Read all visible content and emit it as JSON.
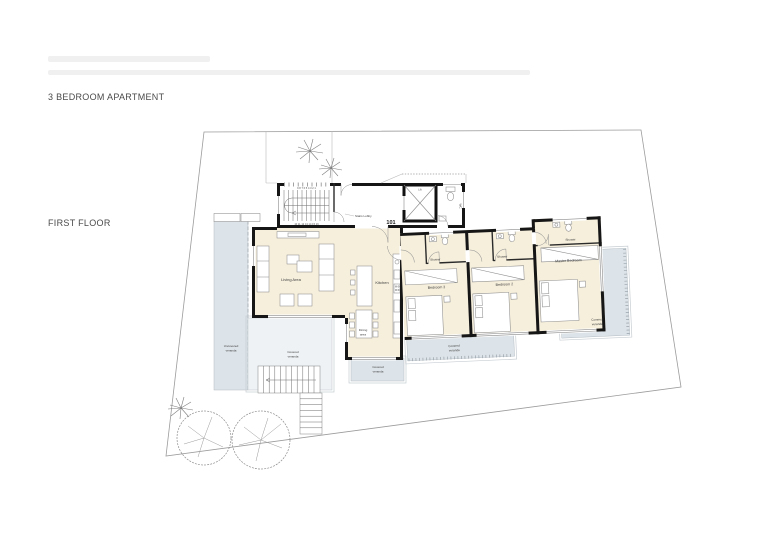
{
  "page": {
    "apartment_title": "3 BEDROOM APARTMENT",
    "floor_label": "FIRST FLOOR"
  },
  "plan": {
    "unit_number": "101",
    "labels": {
      "living": "Living Area",
      "kitchen": "Kitchen",
      "dining_line1": "Dining",
      "dining_line2": "area",
      "stairs_lobby": "Stairs Lobby",
      "lift": "Lift",
      "wc": "WC",
      "shower": "Shower",
      "bedroom3": "Bedroom 3",
      "bedroom2": "Bedroom 2",
      "master_bedroom": "Master Bedroom",
      "covered_line1": "Covered",
      "covered_line2": "veranda",
      "uncovered_line1": "Uncovered",
      "uncovered_line2": "veranda"
    },
    "stairs": {
      "numbers_top": "9 8 7 6 5 4 3 2 1",
      "numbers_bottom": "10 11 12 13 14 15 16"
    },
    "colors": {
      "room_fill": "#f6efdc",
      "veranda_fill": "#dde4e9",
      "wall": "#161616"
    }
  }
}
